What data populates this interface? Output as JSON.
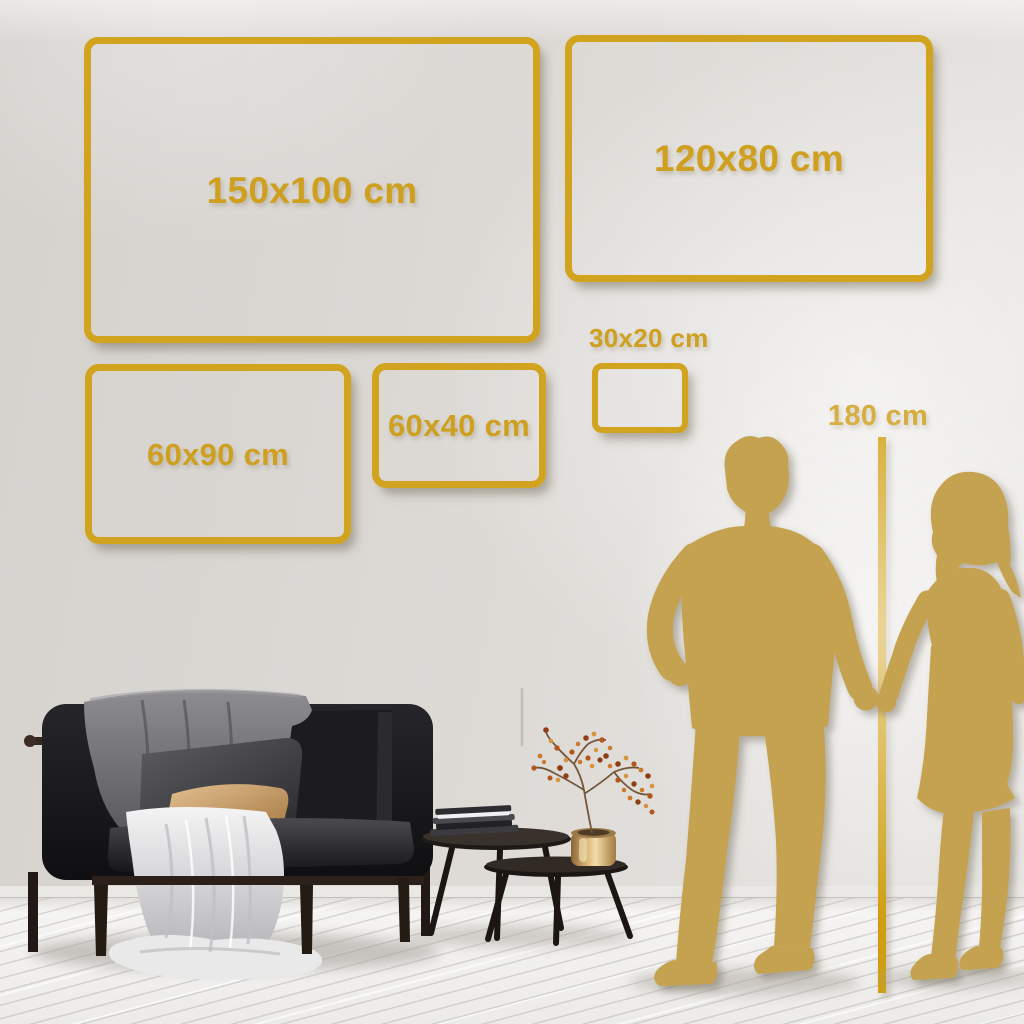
{
  "palette": {
    "accent_gold": "#d2a31f",
    "silhouette_gold": "#c4a24f",
    "wall": "#dedbd7",
    "floor": "#f3f2f0"
  },
  "size_guide": {
    "unit": "cm",
    "frames": [
      {
        "label": "150x100 cm"
      },
      {
        "label": "120x80 cm"
      },
      {
        "label": "60x90 cm"
      },
      {
        "label": "60x40 cm"
      },
      {
        "label": "30x20 cm"
      }
    ],
    "height_reference": {
      "label": "180 cm"
    }
  },
  "scene": {
    "objects": [
      "sofa-with-blankets-and-pillows",
      "nesting-coffee-tables",
      "book-stack",
      "brass-vase-with-dried-branch",
      "man-silhouette",
      "woman-silhouette",
      "height-reference-line"
    ]
  }
}
